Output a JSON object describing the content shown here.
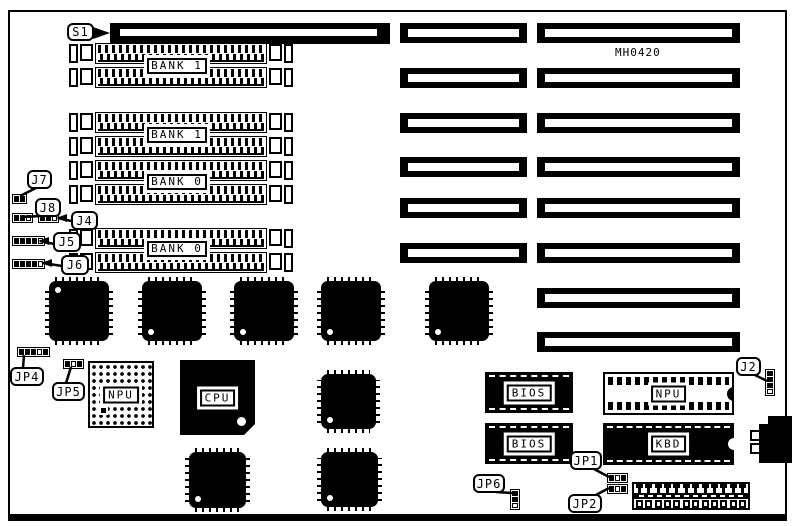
{
  "board": {
    "part_number": "MH0420"
  },
  "callouts": {
    "s1": "S1",
    "j7": "J7",
    "j8": "J8",
    "j4": "J4",
    "j5": "J5",
    "j6": "J6",
    "jp4": "JP4",
    "jp5": "JP5",
    "jp1": "JP1",
    "jp2": "JP2",
    "jp6": "JP6",
    "j2": "J2"
  },
  "memory_banks": [
    {
      "label": "BANK 1"
    },
    {
      "label": "BANK 1"
    },
    {
      "label": "BANK 0"
    },
    {
      "label": "BANK 0"
    }
  ],
  "chips": {
    "cpu": "CPU",
    "npu_socket": "NPU",
    "npu_dip": "NPU",
    "bios_upper": "BIOS",
    "bios_lower": "BIOS",
    "keyboard_controller": "KBD"
  },
  "colors": {
    "ink": "#000000",
    "paper": "#ffffff"
  }
}
